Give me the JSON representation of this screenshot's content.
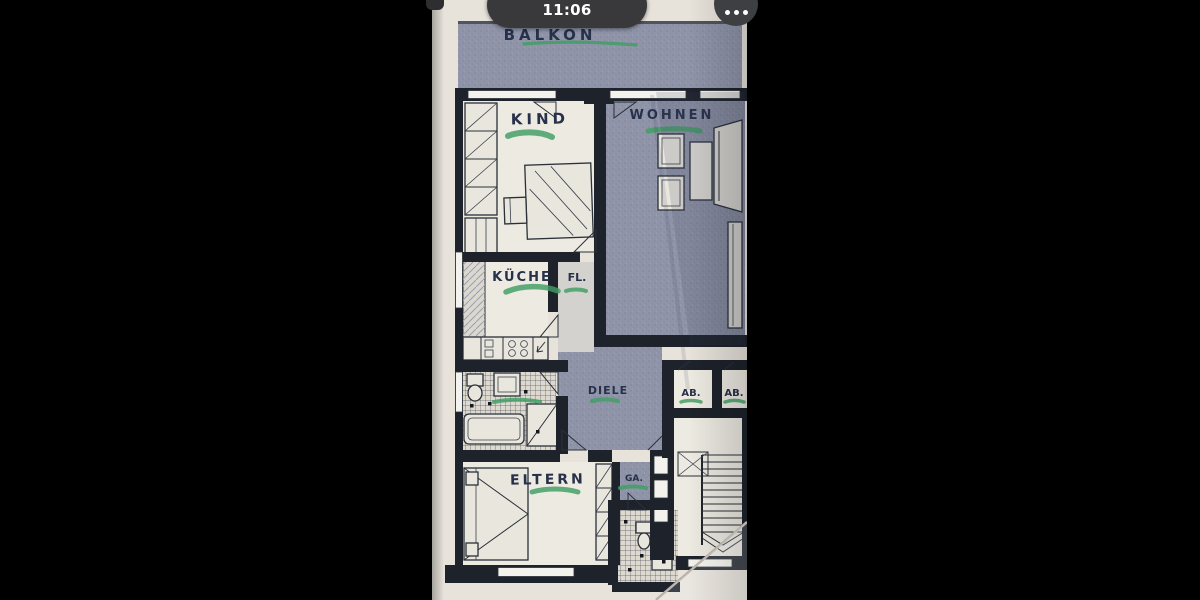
{
  "statusbar": {
    "pill_title": "Heute",
    "pill_time": "11:06",
    "more_icon": "ellipsis"
  },
  "floorplan": {
    "labels": {
      "balkon": "BALKON",
      "kind": "KIND",
      "wohnen": "WOHNEN",
      "kueche": "KÜCHE",
      "fl": "FL.",
      "diele": "DIELE",
      "ab1": "AB.",
      "ab2": "AB.",
      "ga": "GA.",
      "eltern": "ELTERN"
    },
    "colors": {
      "paper": "#e7e3db",
      "wall": "#1d222b",
      "shade": "#8f94a9",
      "shade_dark": "#7c8198",
      "tile_bg": "#ded9cf",
      "highlight": "#3f9e63",
      "ink": "#27314a"
    }
  }
}
